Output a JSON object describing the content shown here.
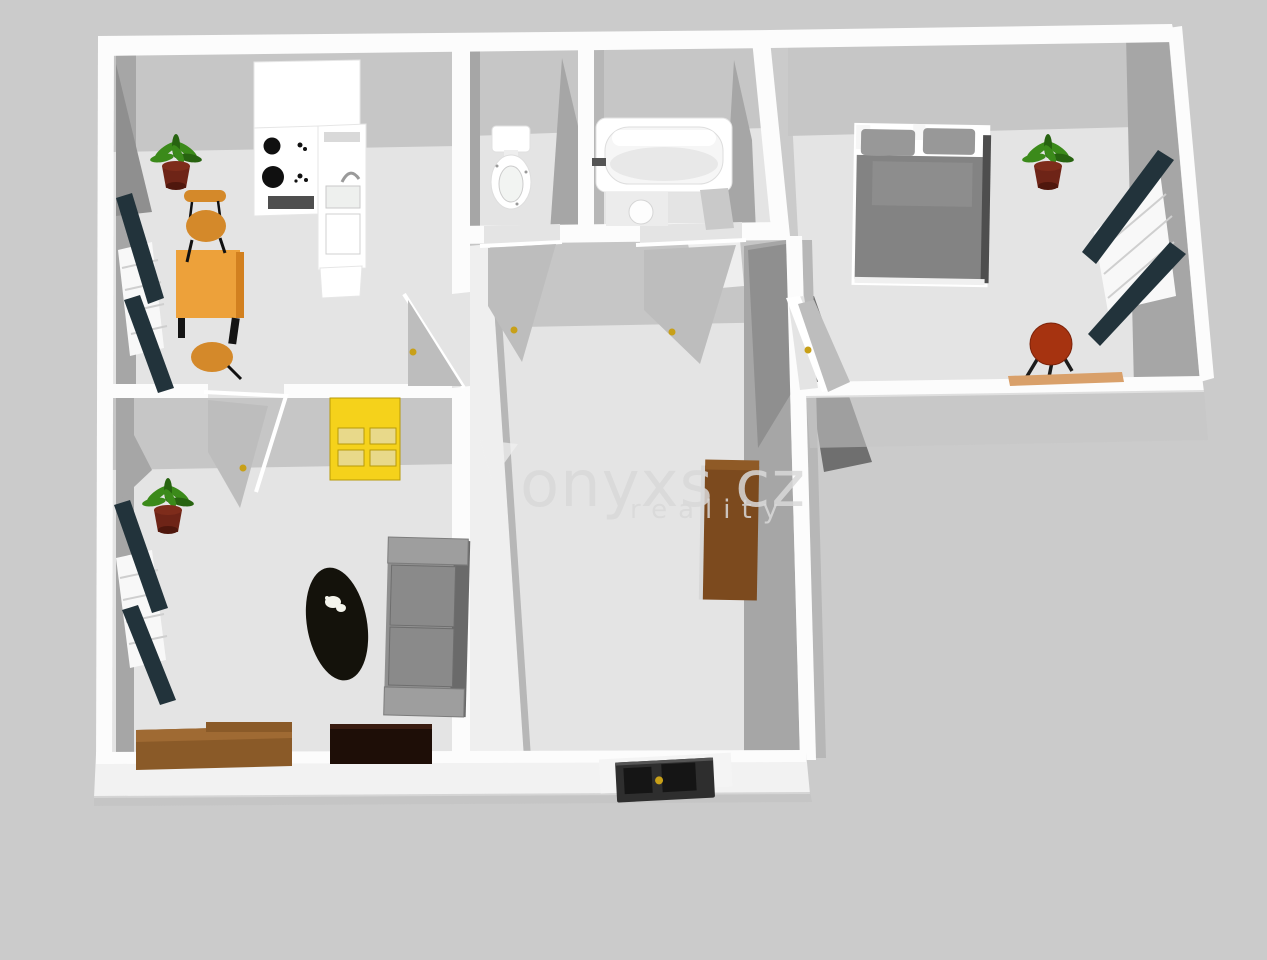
{
  "watermark": {
    "brand": "onyxs cz",
    "tagline": "reality"
  },
  "colors": {
    "bg": "#cbcbcb",
    "floor": "#e4e4e4",
    "floor-light": "#eeeeee",
    "wall-white": "#fcfcfc",
    "wall-soft": "#efefef",
    "face-light": "#c6c6c6",
    "face-mid": "#a6a6a6",
    "face-soft": "#b7b7b7",
    "face-dark": "#8f8f8f",
    "face-darker": "#6f6f6f",
    "radiator": "#22333b",
    "window-white": "#f8f8f8",
    "table-orange": "#eda13a",
    "seat-orange": "#d4892a",
    "wood-edge": "#d2801f",
    "plant-green": "#3b8a1a",
    "plant-green-dark": "#276310",
    "pot-brown": "#6e2417",
    "bed-gray": "#838383",
    "pillow-gray": "#989898",
    "bed-dark": "#4e4e4e",
    "sofa-gray": "#909090",
    "sofa-light": "#9e9e9e",
    "sofa-dark": "#6a6a6a",
    "cushion-gray": "#8a8a8a",
    "rug-black": "#14120b",
    "dresser-yellow": "#f5d21b",
    "dresser-drawer": "#e8d98a",
    "dresser-line": "#b89a08",
    "sideboard-brown": "#8a5a28",
    "sideboard-top": "#9f6a33",
    "tv-dark": "#1e0e07",
    "cabinet-brown": "#7c4a1e",
    "stool-red": "#a63310",
    "tan-strip": "#d9a06a",
    "door-leaf": "#bdbdbd",
    "handle-yellow": "#c8a018",
    "entrance-dark": "#2e2e2e",
    "entrance-panel": "#151515",
    "appliance-dark": "#4e4e4e",
    "burner-black": "#101010",
    "watermark-gray": "#d9d9d9"
  },
  "scene": {
    "view": "3d-floorplan-render",
    "rooms": [
      {
        "name": "kitchen-dining",
        "objects": [
          "kitchen-counter",
          "stove",
          "sink-unit",
          "dining-table",
          "chair",
          "stool",
          "potted-plant",
          "radiator",
          "window",
          "door-to-hall"
        ]
      },
      {
        "name": "living-room",
        "objects": [
          "yellow-dresser",
          "sofa",
          "oval-rug",
          "cat",
          "sideboard",
          "tv-cabinet",
          "potted-plant",
          "radiator",
          "window",
          "door"
        ]
      },
      {
        "name": "wc",
        "objects": [
          "toilet",
          "door"
        ]
      },
      {
        "name": "bathroom",
        "objects": [
          "bathtub",
          "sink",
          "door"
        ]
      },
      {
        "name": "hall",
        "objects": [
          "wardrobe-cabinet",
          "entrance-door"
        ]
      },
      {
        "name": "bedroom",
        "objects": [
          "double-bed",
          "potted-plant",
          "radiator",
          "window",
          "round-stool",
          "door"
        ]
      }
    ]
  }
}
